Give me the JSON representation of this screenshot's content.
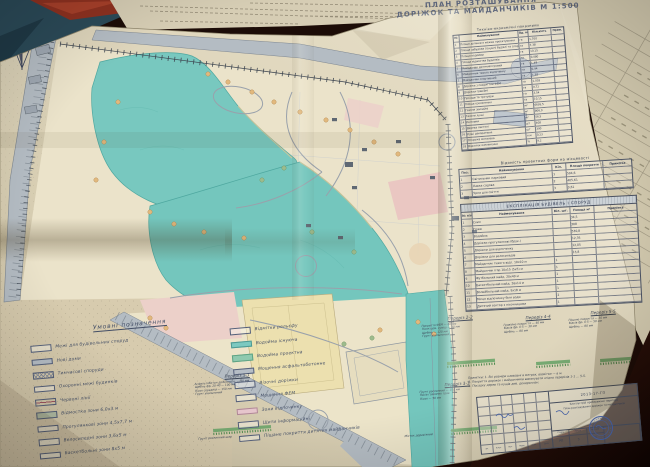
{
  "title": {
    "line1": "ПЛАН РОЗТАШУВАННЯ",
    "line2": "ДОРІЖОК ТА МАЙДАНЧИКІВ  М 1:500"
  },
  "tables": {
    "indicators": {
      "title": "Техніко-економічні показники",
      "headers": [
        "№",
        "Найменування",
        "Од. вим.",
        "Кількість",
        "Прим."
      ],
      "rows": [
        {
          "n": "1",
          "name": "Площа ділянки в межах проектування",
          "u": "га",
          "q": "1,700",
          "p": ""
        },
        {
          "n": "2",
          "name": "Площа забудови (існуючі будівлі та споруди)",
          "u": "га",
          "q": "7,38",
          "p": ""
        },
        {
          "n": "3",
          "name": "Площа водойми",
          "u": "га",
          "q": "10,15",
          "p": ""
        },
        {
          "n": "4",
          "name": "Площа відмостки будинків",
          "u": "га",
          "q": "0,080",
          "p": ""
        },
        {
          "n": "5",
          "name": "Майданчик дитячий ігровий",
          "u": "га",
          "q": "1,48",
          "p": ""
        },
        {
          "n": "6",
          "name": "Майданчик тихого відпочинку",
          "u": "га",
          "q": "0,94",
          "p": ""
        },
        {
          "n": "7",
          "name": "Майданчик спортивний",
          "u": "га",
          "q": "1,38",
          "p": ""
        },
        {
          "n": "8",
          "name": "Доріжки з покриттям ФЕМ",
          "u": "га",
          "q": "1,003",
          "p": ""
        },
        {
          "n": "9",
          "name": "Доріжки гравійні",
          "u": "га",
          "q": "0,72",
          "p": ""
        },
        {
          "n": "10",
          "name": "Проїзди та тротуари",
          "u": "га",
          "q": "3,54",
          "p": ""
        },
        {
          "n": "11",
          "name": "Площа озеленення",
          "u": "га",
          "q": "10,15",
          "p": ""
        },
        {
          "n": "12",
          "name": "Газони звичайні",
          "u": "м²",
          "q": "6695,5",
          "p": ""
        },
        {
          "n": "13",
          "name": "Газони лучні",
          "u": "м²",
          "q": "806,0",
          "p": ""
        },
        {
          "n": "14",
          "name": "Квітники",
          "u": "м²",
          "q": "56,5",
          "p": ""
        },
        {
          "n": "15",
          "name": "Дерева листяні",
          "u": "шт",
          "q": "408",
          "p": ""
        },
        {
          "n": "16",
          "name": "Кущі декоративні",
          "u": "шт",
          "q": "390",
          "p": ""
        },
        {
          "n": "17",
          "name": "Огорожа металева",
          "u": "п.м",
          "q": "0,23",
          "p": ""
        },
        {
          "n": "18",
          "name": "Відсоток озеленення",
          "u": "%",
          "q": "9,2",
          "p": ""
        }
      ]
    },
    "forms": {
      "title": "Відомість проектних форм на місцевості",
      "headers": [
        "Поз.",
        "Найменування",
        "Кіл.",
        "Площа покриття",
        "Примітка"
      ],
      "rows": [
        {
          "n": "1",
          "name": "Світильник парковий",
          "q": "1",
          "a": "504,6",
          "p": ""
        },
        {
          "n": "2",
          "name": "Лавка садова",
          "q": "2",
          "a": "405,61",
          "p": ""
        },
        {
          "n": "3",
          "name": "Урна для сміття",
          "q": "3",
          "a": "0,61",
          "p": ""
        }
      ]
    },
    "explication": {
      "title": "ЕКСПЛІКАЦІЯ БУДІВЕЛЬ І СПОРУД",
      "headers": [
        "№ п/п",
        "Найменування",
        "Кіл. шт.",
        "Площа м²",
        "Примітка"
      ],
      "rows": [
        {
          "n": "1",
          "name": "Схил",
          "q": "",
          "a": "34,5",
          "p": ""
        },
        {
          "n": "2",
          "name": "Пляж",
          "q": "",
          "a": "308",
          "p": ""
        },
        {
          "n": "3",
          "name": "Водойма",
          "q": "",
          "a": "530,8",
          "p": ""
        },
        {
          "n": "4",
          "name": "Доріжки прогулянкові (брук.)",
          "q": "",
          "a": "12,35",
          "p": ""
        },
        {
          "n": "5",
          "name": "Доріжки для відпочинку",
          "q": "",
          "a": "12,05",
          "p": ""
        },
        {
          "n": "6",
          "name": "Доріжки для велосипедів",
          "q": "",
          "a": "13,8",
          "p": ""
        },
        {
          "n": "7",
          "name": "Майданчик тихого відп. 10х10 м",
          "q": "1",
          "a": "",
          "p": ""
        },
        {
          "n": "8",
          "name": "Майданчик ігор 10х15 (5х5) м",
          "q": "1",
          "a": "",
          "p": ""
        },
        {
          "n": "9",
          "name": "Футбольний майд. 20х40 м",
          "q": "1",
          "a": "",
          "p": ""
        },
        {
          "n": "10",
          "name": "Баскетбольний майд. 26х14 м",
          "q": "1",
          "a": "",
          "p": ""
        },
        {
          "n": "11",
          "name": "Волейбольний майд. 9х18 м",
          "q": "1",
          "a": "",
          "p": ""
        },
        {
          "n": "12",
          "name": "Місця відпочинку біля води",
          "q": "2",
          "a": "",
          "p": ""
        },
        {
          "n": "13",
          "name": "Дитячий сектор з пісочницями",
          "q": "1",
          "a": "",
          "p": ""
        }
      ]
    }
  },
  "legend": {
    "title": "Умовні позначення",
    "items": [
      {
        "sw": "outline",
        "label": "Межі для будівельних споруд"
      },
      {
        "sw": "grey",
        "label": "Нові доми"
      },
      {
        "sw": "xhatch",
        "label": "Тимчасові споруди"
      },
      {
        "sw": "darkline",
        "label": "Охоронні межі будинків"
      },
      {
        "sw": "redline",
        "label": "Червоні лінії"
      },
      {
        "sw": "greygreen",
        "label": "Відмостка зони 6,0х3 м"
      },
      {
        "sw": "outline",
        "label": "Прогулянкові зони 4,5х7,7 м"
      },
      {
        "sw": "outline",
        "label": "Велосипедні зони 3,6х5 м"
      },
      {
        "sw": "outline",
        "label": "Баскетбольні зони 8х5 м"
      },
      {
        "sw": "outline",
        "label": "Відмітки рельєфу"
      },
      {
        "sw": "teal",
        "label": "Водойма існуюча"
      },
      {
        "sw": "tealgreen",
        "label": "Водойма проектна"
      },
      {
        "sw": "grey",
        "label": "Мощення асфальтобетонне"
      },
      {
        "sw": "outline",
        "label": "Візочні доріжки"
      },
      {
        "sw": "outline",
        "label": "Мощення ФЕМ"
      },
      {
        "sw": "pink",
        "label": "Зони відпочинку"
      },
      {
        "sw": "outline",
        "label": "Щити інформаційні"
      },
      {
        "sw": "outline",
        "label": "Піщане покриття дитячих майданчиків"
      }
    ]
  },
  "sections": {
    "s11": {
      "label": "Переріз 1-1",
      "specs": [
        "Асфальтобетон дрібнозерн. — 40 мм",
        "Щебінь фр. 20-40 — 100 мм",
        "Пісок середній — 150 мм",
        "Ґрунт ущільнений"
      ],
      "note": "Ґрунт рослинний шар"
    },
    "s22": {
      "label": "Переріз 2-2",
      "specs": [
        "Покриття ФЕМ — 60 мм",
        "Пісок цем. суміш — 30 мм",
        "Щебінь — 120 мм",
        "Ґрунт ущільнений"
      ],
      "note": ""
    },
    "s33": {
      "label": "Переріз 3-3",
      "specs": [
        "Ґрунт рослинний — 150 мм",
        "Посів газонних трав",
        "Пісок — 50 мм"
      ],
      "note": "Місток дерев'яний"
    },
    "s44": {
      "label": "Переріз 4-4",
      "specs": [
        "Гравійне покриття — 40 мм",
        "Відсів фр. 0-5 — 30 мм",
        "Щебінь — 80 мм"
      ],
      "note": ""
    },
    "s55": {
      "label": "Переріз 5-5",
      "specs": [
        "Піщане покриття — 30 мм",
        "Відсів фр. 0-5 — 50 мм",
        "Щебінь — 80 мм"
      ],
      "note": ""
    }
  },
  "notes": {
    "lines": [
      "Примітки: 1. Всі розміри наведені в метрах, відмітки — в м.",
      "2. Покриття доріжок і майданчиків виконувати згідно перерізів 1-1 … 5-5.",
      "3. Посадку дерев та кущів див. дендроплан."
    ]
  },
  "stamp": {
    "code": "2013-17-ГП",
    "line1": "Благоустрій прибережної території",
    "line2": "План розташування доріжок та майданчиків",
    "stage_label": "Стадія",
    "sheet_label": "Аркуш",
    "sheets_label": "Аркушів",
    "stage": "РП",
    "sheet": "3",
    "sheets": "7",
    "rev_headers": [
      "Зм.",
      "Кільк.",
      "Арк.",
      "№док.",
      "Підп.",
      "Дата"
    ]
  },
  "colors": {
    "paper": "#ded5bc",
    "pond_teal": "#78c8bf",
    "road_grey": "#b4bcc3",
    "playground_pink": "#ecccc7",
    "field_yellow": "#ece0b0",
    "section_green": "#66a366",
    "stamp_blue": "#4866b0",
    "bg_table_blue": "#2b4a58",
    "bg_red_object": "#8e3120",
    "bg_dark_wood": "#1c0c07",
    "ink": "#3f4a58"
  }
}
